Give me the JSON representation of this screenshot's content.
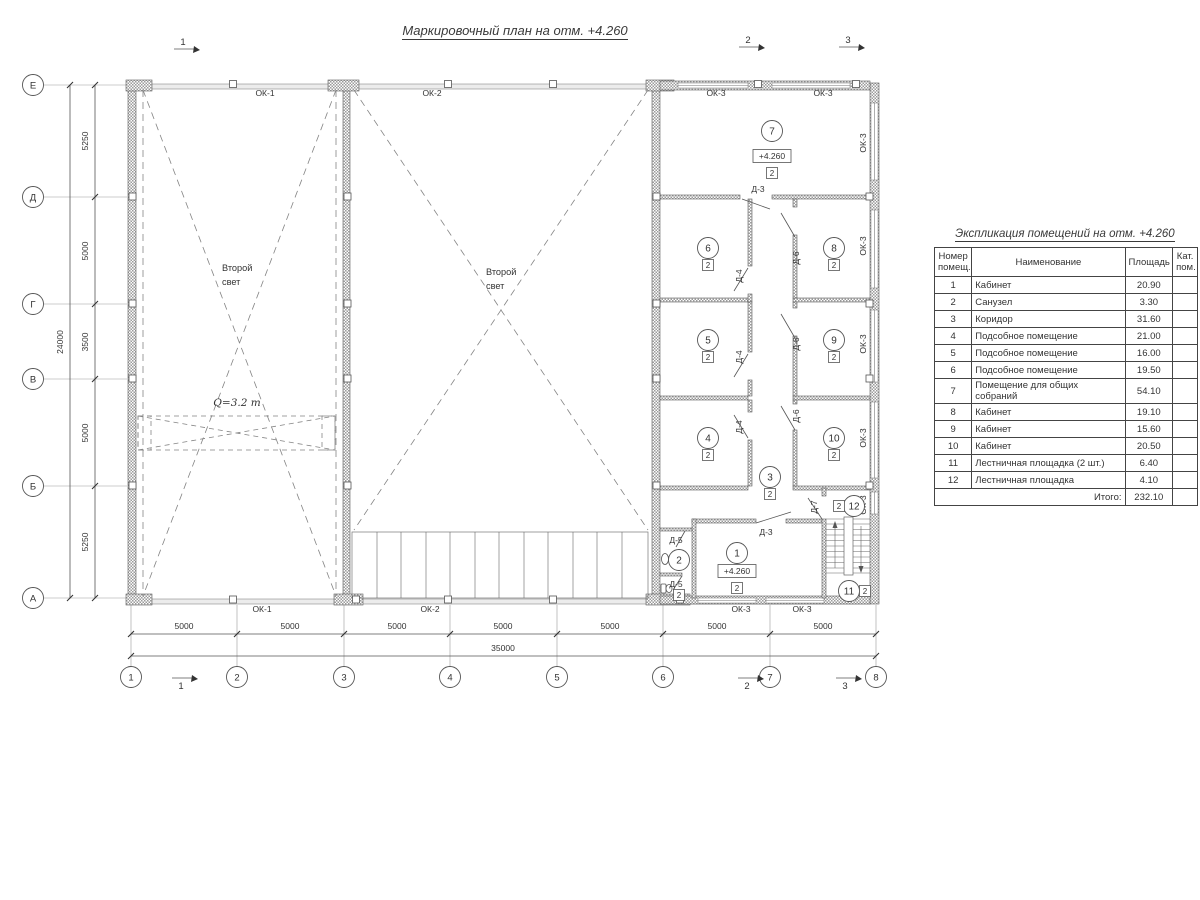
{
  "title": "Маркировочный план на отм. +4.260",
  "table": {
    "title": "Экспликация помещений на отм. +4.260",
    "headers": {
      "num": "Номер помещ.",
      "name": "Наименование",
      "area": "Площадь",
      "cat": "Кат. пом."
    },
    "rows": [
      {
        "num": "1",
        "name": "Кабинет",
        "area": "20.90",
        "cat": ""
      },
      {
        "num": "2",
        "name": "Санузел",
        "area": "3.30",
        "cat": ""
      },
      {
        "num": "3",
        "name": "Коридор",
        "area": "31.60",
        "cat": ""
      },
      {
        "num": "4",
        "name": "Подсобное помещение",
        "area": "21.00",
        "cat": ""
      },
      {
        "num": "5",
        "name": "Подсобное помещение",
        "area": "16.00",
        "cat": ""
      },
      {
        "num": "6",
        "name": "Подсобное помещение",
        "area": "19.50",
        "cat": ""
      },
      {
        "num": "7",
        "name": "Помещение для общих собраний",
        "area": "54.10",
        "cat": ""
      },
      {
        "num": "8",
        "name": "Кабинет",
        "area": "19.10",
        "cat": ""
      },
      {
        "num": "9",
        "name": "Кабинет",
        "area": "15.60",
        "cat": ""
      },
      {
        "num": "10",
        "name": "Кабинет",
        "area": "20.50",
        "cat": ""
      },
      {
        "num": "11",
        "name": "Лестничная площадка (2 шт.)",
        "area": "6.40",
        "cat": ""
      },
      {
        "num": "12",
        "name": "Лестничная площадка",
        "area": "4.10",
        "cat": ""
      }
    ],
    "total_label": "Итого:",
    "total": "232.10"
  },
  "grid": {
    "rows": [
      "Е",
      "Д",
      "Г",
      "В",
      "Б",
      "А"
    ],
    "cols": [
      "1",
      "2",
      "3",
      "4",
      "5",
      "6",
      "7",
      "8"
    ],
    "row_dims": [
      "5250",
      "5000",
      "3500",
      "5000",
      "5250"
    ],
    "row_total": "24000",
    "col_dims": [
      "5000",
      "5000",
      "5000",
      "5000",
      "5000",
      "5000",
      "5000"
    ],
    "col_total": "35000"
  },
  "sections": {
    "s1": "1",
    "s2": "2",
    "s3": "3"
  },
  "labels": {
    "ok1": "ОК-1",
    "ok2": "ОК-2",
    "ok3": "ОК-3",
    "d3": "Д-3",
    "d4": "Д-4",
    "d5": "Д-5",
    "d6": "Д-6",
    "d7": "Д-7",
    "second_light_1": "Второй",
    "second_light_2": "свет",
    "crane": "Q=3.2 т",
    "elev": "+4.260",
    "cat": "2"
  },
  "rooms": {
    "r1": "1",
    "r2": "2",
    "r3": "3",
    "r4": "4",
    "r5": "5",
    "r6": "6",
    "r7": "7",
    "r8": "8",
    "r9": "9",
    "r10": "10",
    "r11": "11",
    "r12": "12"
  }
}
